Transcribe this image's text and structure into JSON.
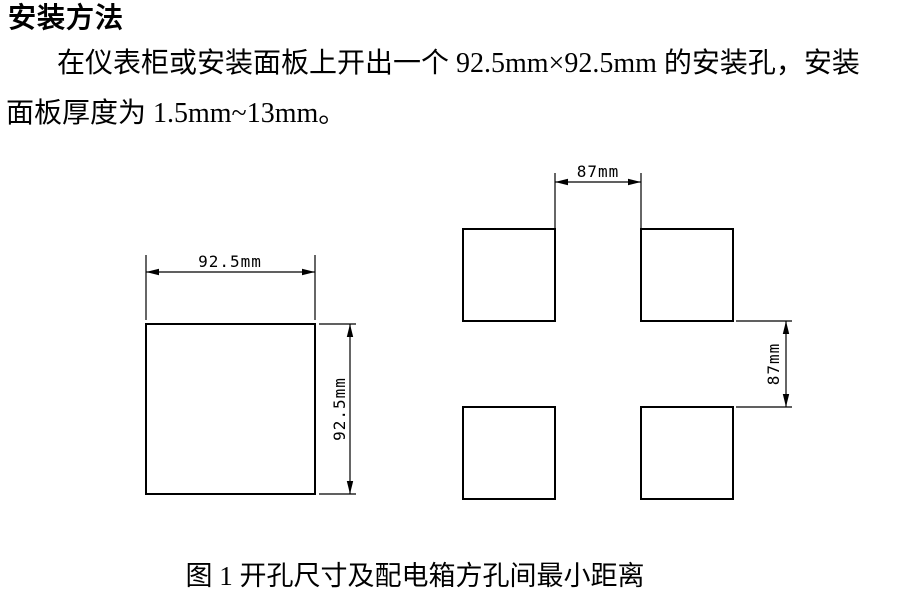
{
  "page": {
    "background": "#ffffff",
    "line_color": "#000000",
    "text_color": "#000000"
  },
  "heading": "安装方法",
  "paragraph": {
    "line1": "在仪表柜或安装面板上开出一个 92.5mm×92.5mm 的安装孔，安装",
    "line2": "面板厚度为 1.5mm~13mm。"
  },
  "figure": {
    "caption": "图 1 开孔尺寸及配电箱方孔间最小距离",
    "single_cutout": {
      "width_label": "92.5mm",
      "height_label": "92.5mm"
    },
    "grid_spacing": {
      "horizontal_gap_label": "87mm",
      "vertical_gap_label": "87mm"
    }
  }
}
